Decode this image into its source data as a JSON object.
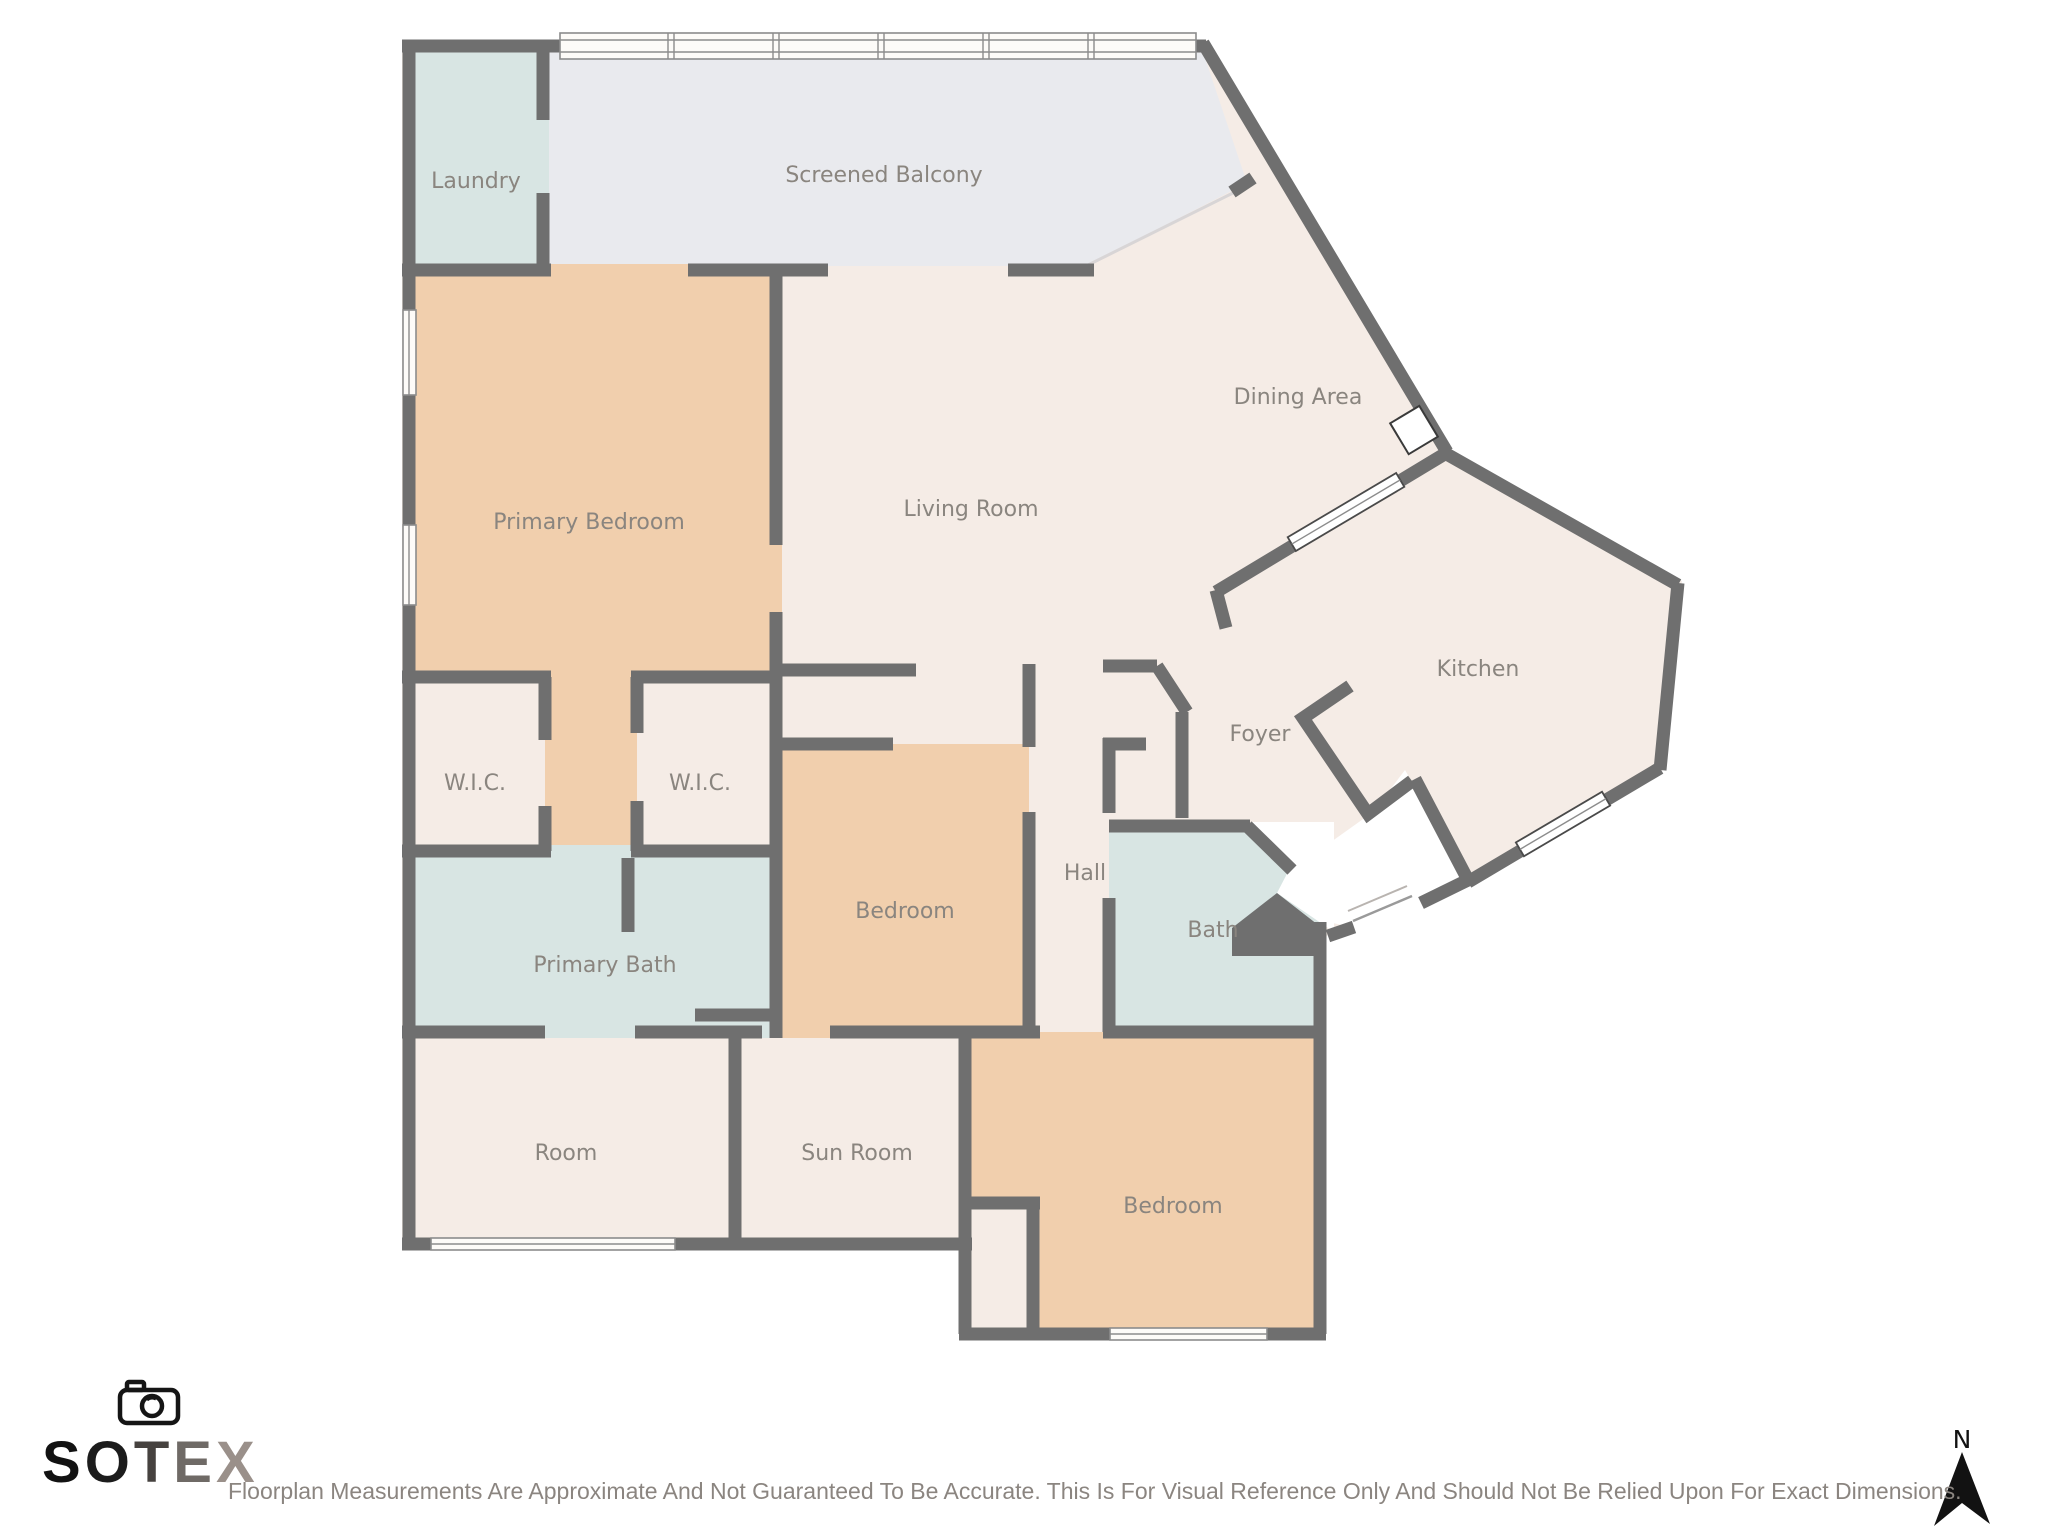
{
  "title": "Floorplan",
  "colors": {
    "wall": "#6f6f6f",
    "room_cream": "#f5ece6",
    "room_peach": "#f1cfad",
    "room_blue": "#d8e5e3",
    "balcony_gray": "#e9eaee",
    "label_text": "#8a857f",
    "disclaimer_text": "#8b8580",
    "north": "#121212"
  },
  "rooms": [
    {
      "id": "laundry",
      "label": "Laundry"
    },
    {
      "id": "screened-balcony",
      "label": "Screened Balcony"
    },
    {
      "id": "primary-bedroom",
      "label": "Primary Bedroom"
    },
    {
      "id": "living-room",
      "label": "Living Room"
    },
    {
      "id": "dining-area",
      "label": "Dining Area"
    },
    {
      "id": "kitchen",
      "label": "Kitchen"
    },
    {
      "id": "foyer",
      "label": "Foyer"
    },
    {
      "id": "wic-1",
      "label": "W.I.C."
    },
    {
      "id": "wic-2",
      "label": "W.I.C."
    },
    {
      "id": "hall",
      "label": "Hall"
    },
    {
      "id": "bath",
      "label": "Bath"
    },
    {
      "id": "primary-bath",
      "label": "Primary Bath"
    },
    {
      "id": "bedroom-middle",
      "label": "Bedroom"
    },
    {
      "id": "room",
      "label": "Room"
    },
    {
      "id": "sun-room",
      "label": "Sun Room"
    },
    {
      "id": "bedroom-bottom",
      "label": "Bedroom"
    }
  ],
  "branding": {
    "letters": [
      {
        "ch": "S",
        "color": "#121212"
      },
      {
        "ch": "O",
        "color": "#1c1c1c"
      },
      {
        "ch": "T",
        "color": "#46423f"
      },
      {
        "ch": "E",
        "color": "#6f6a66"
      },
      {
        "ch": "X",
        "color": "#9a908a"
      }
    ]
  },
  "footer": {
    "disclaimer": "Floorplan Measurements Are Approximate And Not Guaranteed To Be Accurate. This Is For Visual Reference Only And Should Not Be Relied Upon For Exact Dimensions."
  },
  "compass": {
    "label": "N"
  }
}
